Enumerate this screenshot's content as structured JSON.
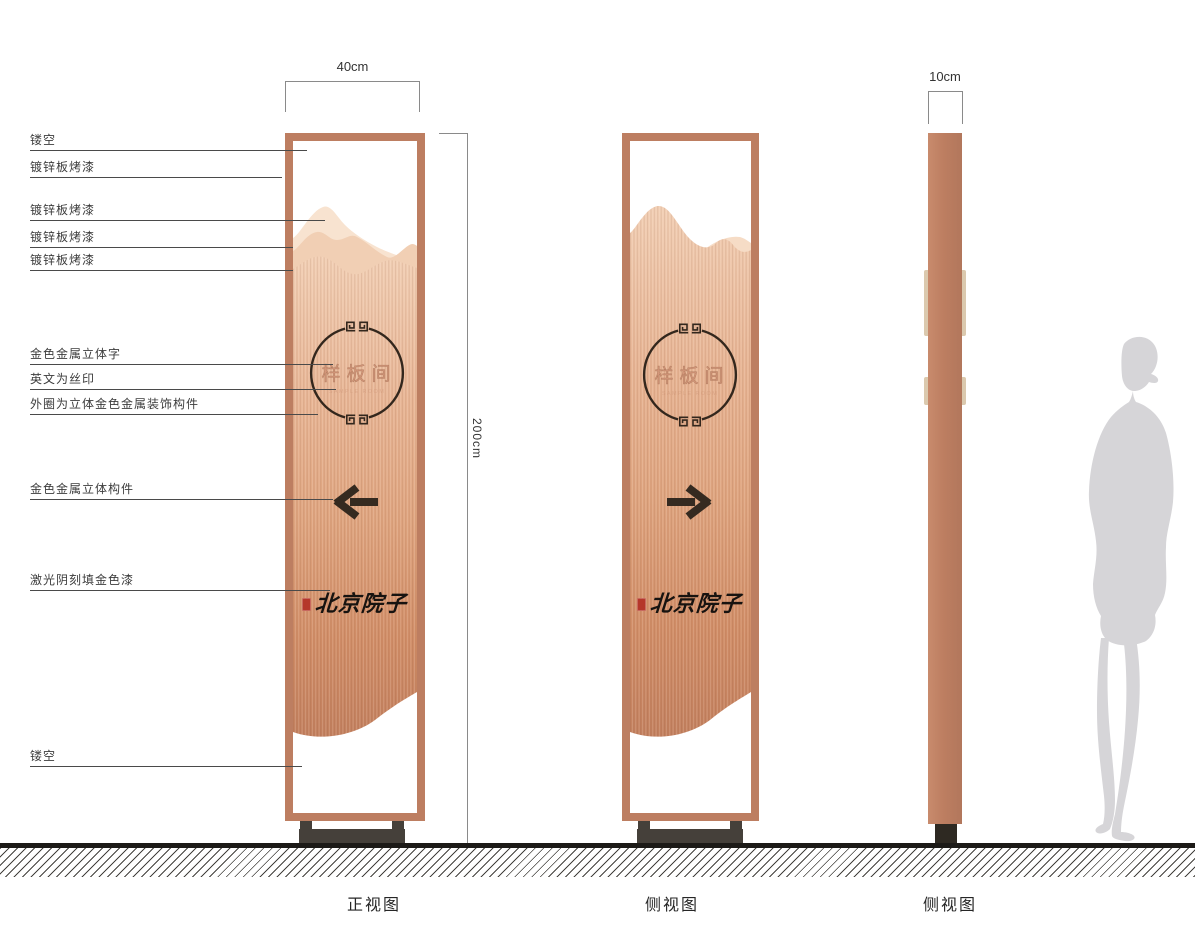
{
  "drawing": {
    "views": [
      {
        "id": "front",
        "label": "正视图"
      },
      {
        "id": "side",
        "label": "侧视图"
      },
      {
        "id": "profile",
        "label": "侧视图"
      }
    ],
    "dimensions": {
      "width": "40cm",
      "height": "200cm",
      "depth": "10cm"
    },
    "callouts": [
      {
        "label": "镂空"
      },
      {
        "label": "镀锌板烤漆"
      },
      {
        "label": "镀锌板烤漆"
      },
      {
        "label": "镀锌板烤漆"
      },
      {
        "label": "镀锌板烤漆"
      },
      {
        "label": "金色金属立体字"
      },
      {
        "label": "英文为丝印"
      },
      {
        "label": "外圈为立体金色金属装饰构件"
      },
      {
        "label": "金色金属立体构件"
      },
      {
        "label": "激光阴刻填金色漆"
      },
      {
        "label": "镂空"
      }
    ],
    "sign_content": {
      "room_name": "样板间",
      "room_name_en": "SAMPLE ROOM",
      "brand": "北京院子",
      "front_arrow": "left",
      "side_arrow": "right"
    },
    "colors": {
      "frame_copper": "#bd7e61",
      "wood_light": "#f2cfb5",
      "wood_dark": "#c3805f",
      "mountain_back": "#f8e3d0",
      "mountain_mid": "#f1cfb4",
      "accent_dark": "#33271d",
      "seal_red": "#b5372a",
      "stand_dark": "#45403a",
      "profile_tab": "#dbc9ae",
      "silhouette_gray": "#d6d5d8"
    }
  }
}
